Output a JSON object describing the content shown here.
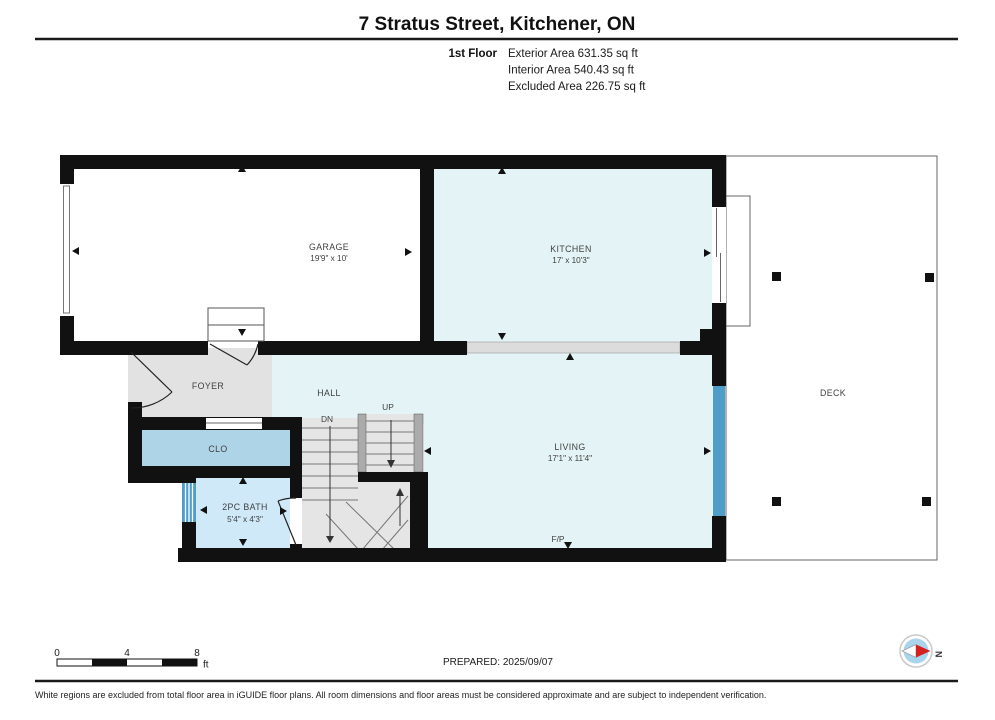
{
  "header": {
    "title": "7 Stratus Street, Kitchener, ON",
    "floor_label": "1st Floor",
    "area_lines": [
      "Exterior Area 631.35 sq ft",
      "Interior Area 540.43 sq ft",
      "Excluded Area 226.75 sq ft"
    ]
  },
  "rooms": {
    "garage": {
      "label": "GARAGE",
      "dims": "19'9\" x 10'"
    },
    "kitchen": {
      "label": "KITCHEN",
      "dims": "17' x 10'3\""
    },
    "living": {
      "label": "LIVING",
      "dims": "17'1\" x 11'4\""
    },
    "bath": {
      "label": "2PC BATH",
      "dims": "5'4\" x 4'3\""
    },
    "foyer": {
      "label": "FOYER"
    },
    "hall": {
      "label": "HALL"
    },
    "closet": {
      "label": "CLO"
    },
    "deck": {
      "label": "DECK"
    },
    "fireplace": {
      "label": "F/P"
    },
    "stairs": {
      "up": "UP",
      "down": "DN"
    }
  },
  "scale_bar": {
    "ticks": [
      "0",
      "4",
      "8"
    ],
    "unit": "ft"
  },
  "footer": {
    "prepared": "PREPARED: 2025/09/07",
    "disclaimer": "White regions are excluded from total floor area in iGUIDE floor plans. All room dimensions and floor areas must be considered approximate and are subject to independent verification.",
    "compass_north": "N"
  },
  "colors": {
    "wall": "#111111",
    "interior": "#e4f3f5",
    "closet_fill": "#aed4e8",
    "bath_fill": "#cfe9f9",
    "foyer_fill": "#e2e2e2",
    "stair_fill": "#e5e5e5",
    "rail": "#ababab",
    "halfwall": "#dcdcdc",
    "window": "#4f9ec9",
    "compass_blue": "#a8d4ec",
    "compass_red": "#d61f1f"
  }
}
